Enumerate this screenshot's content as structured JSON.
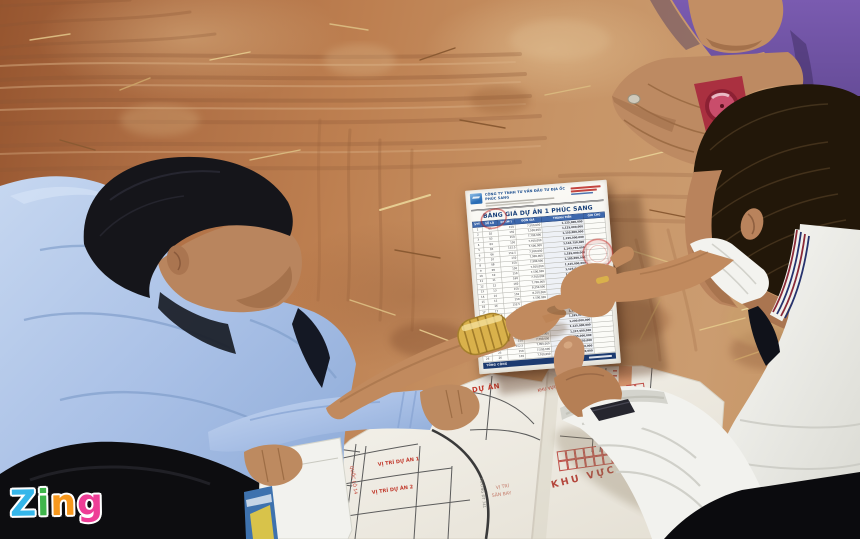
{
  "watermark": {
    "word": "Zing",
    "letters": [
      {
        "char": "Z",
        "color": "#35b6ea"
      },
      {
        "char": "i",
        "color": "#3fb54b"
      },
      {
        "char": "n",
        "color": "#f8981d"
      },
      {
        "char": "g",
        "color": "#ee3d96"
      }
    ]
  },
  "price_sheet": {
    "company": "CÔNG TY TNHH TƯ VẤN ĐẦU TƯ ĐỊA ỐC PHÚC SANG",
    "title": "BẢNG GIÁ DỰ ÁN 1 PHÚC SANG",
    "table": {
      "headers": [
        "STT",
        "SỐ LÔ",
        "DT (M²)",
        "ĐƠN GIÁ",
        "THÀNH TIỀN",
        "GHI CHÚ"
      ],
      "rows": [
        [
          "1",
          "01",
          "150",
          "7,500,000",
          "1,125,000,000"
        ],
        [
          "2",
          "02",
          "150",
          "7,500,000",
          "1,125,000,000"
        ],
        [
          "3",
          "03",
          "150",
          "7,700,000",
          "1,155,000,000"
        ],
        [
          "4",
          "04",
          "150",
          "7,700,000",
          "1,155,000,000"
        ],
        [
          "5",
          "05",
          "152.5",
          "7,500,000",
          "1,143,750,000"
        ],
        [
          "6",
          "06",
          "152.5",
          "7,500,000",
          "1,143,750,000"
        ],
        [
          "7",
          "07",
          "150",
          "7,900,000",
          "1,185,000,000"
        ],
        [
          "8",
          "08",
          "150",
          "7,900,000",
          "1,185,000,000"
        ],
        [
          "9",
          "09",
          "150",
          "7,500,000",
          "1,125,000,000"
        ],
        [
          "10",
          "10",
          "150",
          "7,500,000",
          "1,125,000,000"
        ],
        [
          "11",
          "11",
          "160",
          "7,700,000",
          "1,232,000,000"
        ],
        [
          "12",
          "12",
          "160",
          "7,700,000",
          "1,232,000,000"
        ],
        [
          "13",
          "13",
          "150",
          "8,250,000",
          "1,237,500,000"
        ],
        [
          "14",
          "14",
          "150",
          "8,250,000",
          "1,237,500,000"
        ],
        [
          "15",
          "15",
          "150",
          "7,500,000",
          "1,125,000,000"
        ],
        [
          "16",
          "16",
          "152.5",
          "7,500,000",
          "1,143,750,000"
        ],
        [
          "17",
          "17",
          "150",
          "7,700,000",
          "1,155,000,000"
        ],
        [
          "18",
          "18",
          "150",
          "7,700,000",
          "1,155,000,000"
        ],
        [
          "19",
          "19",
          "150",
          "7,900,000",
          "1,185,000,000"
        ],
        [
          "20",
          "20",
          "160",
          "7,500,000",
          "1,200,000,000"
        ],
        [
          "21",
          "21",
          "150",
          "7,500,000",
          "1,125,000,000"
        ],
        [
          "22",
          "22",
          "150",
          "8,250,000",
          "1,237,500,000"
        ],
        [
          "23",
          "23",
          "150",
          "7,700,000",
          "1,155,000,000"
        ],
        [
          "24",
          "24",
          "152.5",
          "7,900,000",
          "1,204,750,000"
        ],
        [
          "25",
          "25",
          "150",
          "7,500,000",
          "1,125,000,000"
        ],
        [
          "26",
          "26",
          "150",
          "7,700,000",
          "1,155,000,000"
        ]
      ],
      "total_label": "TỔNG CỘNG"
    }
  },
  "map": {
    "title": "ĐƯỜNG KẾT NỐI KHU VỰC CÁC DỰ ÁN",
    "subtitle": "CHỦ ĐẦU TƯ: CÔNG TY ĐỊA ỐC PHÚC SANG",
    "labels": {
      "project1": "VỊ TRÍ DỰ ÁN 1",
      "project2": "VỊ TRÍ DỰ ÁN 2",
      "airport1": "VỊ TRÍ",
      "airport2": "SÂN BAY",
      "area": "KHU VỰC DỰ ÁN",
      "khu_small": "KHU VỰC",
      "highway": "QUỐC LỘ 14",
      "road": "ĐƯỜNG ĐT 741"
    }
  },
  "colors": {
    "shirt_blue": "#a9c0e6",
    "shirt_purple": "#6a4b9c",
    "shirt_white": "#f2f2ee",
    "ground": "#bd7f50",
    "paper": "#f6f5f0",
    "stamp_red": "#c62822",
    "table_header_blue": "#3d68ad",
    "map_label_red": "#c23b2e",
    "watch_red": "#c94d6b",
    "bracelet_gold": "#d9b14b"
  }
}
